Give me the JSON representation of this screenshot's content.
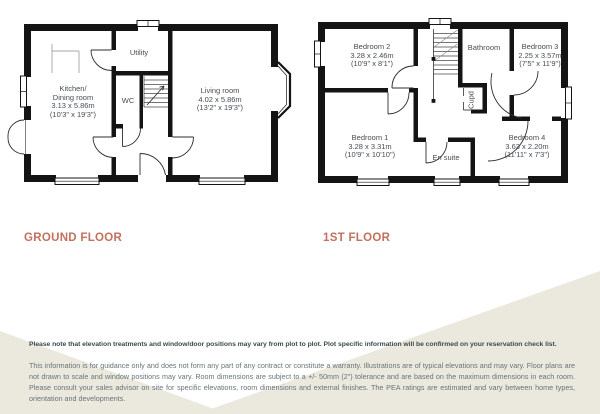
{
  "page": {
    "accent_color": "#c3705e",
    "beige_color": "#ebe8de",
    "wall_color": "#141414"
  },
  "ground_floor": {
    "title": "GROUND FLOOR",
    "rooms": {
      "kitchen": {
        "lines": [
          "Kitchen/",
          "Dining room",
          "3.13 x 5.86m",
          "(10'3\" x 19'3\")"
        ]
      },
      "utility": {
        "lines": [
          "Utility"
        ]
      },
      "wc": {
        "lines": [
          "WC"
        ]
      },
      "living_room": {
        "lines": [
          "Living room",
          "4.02 x 5.86m",
          "(13'2\" x 19'3\")"
        ]
      }
    }
  },
  "first_floor": {
    "title": "1ST FLOOR",
    "rooms": {
      "bedroom2": {
        "lines": [
          "Bedroom 2",
          "3.28 x 2.46m",
          "(10'9\" x 8'1\")"
        ]
      },
      "bathroom": {
        "lines": [
          "Bathroom"
        ]
      },
      "bedroom3": {
        "lines": [
          "Bedroom 3",
          "2.25 x 3.57m",
          "(7'5\" x 11'9\")"
        ]
      },
      "cupboard": {
        "lines": [
          "Cupd"
        ]
      },
      "bedroom1": {
        "lines": [
          "Bedroom 1",
          "3.28 x 3.31m",
          "(10'9\" x 10'10\")"
        ]
      },
      "ensuite": {
        "lines": [
          "En suite"
        ]
      },
      "bedroom4": {
        "lines": [
          "Bedroom 4",
          "3.63 x 2.20m",
          "(11'11\" x 7'3\")"
        ]
      }
    }
  },
  "disclaimer": {
    "note": "Please note that elevation treatments and window/door positions may vary from plot to plot. Plot specific information will be confirmed on your reservation check list.",
    "body": "This information is for guidance only and does not form any part of any contract or constitute a warranty. Illustrations are of typical elevations and may vary. Floor plans are not drawn to scale and window positions may vary. Room dimensions are subject to a +/- 50mm (2\") tolerance and are based on the maximum dimensions in each room. Please consult your sales advisor on site for specific elevations, room dimensions and external finishes. The PEA ratings are estimated and vary between home types, orientation and developments."
  }
}
